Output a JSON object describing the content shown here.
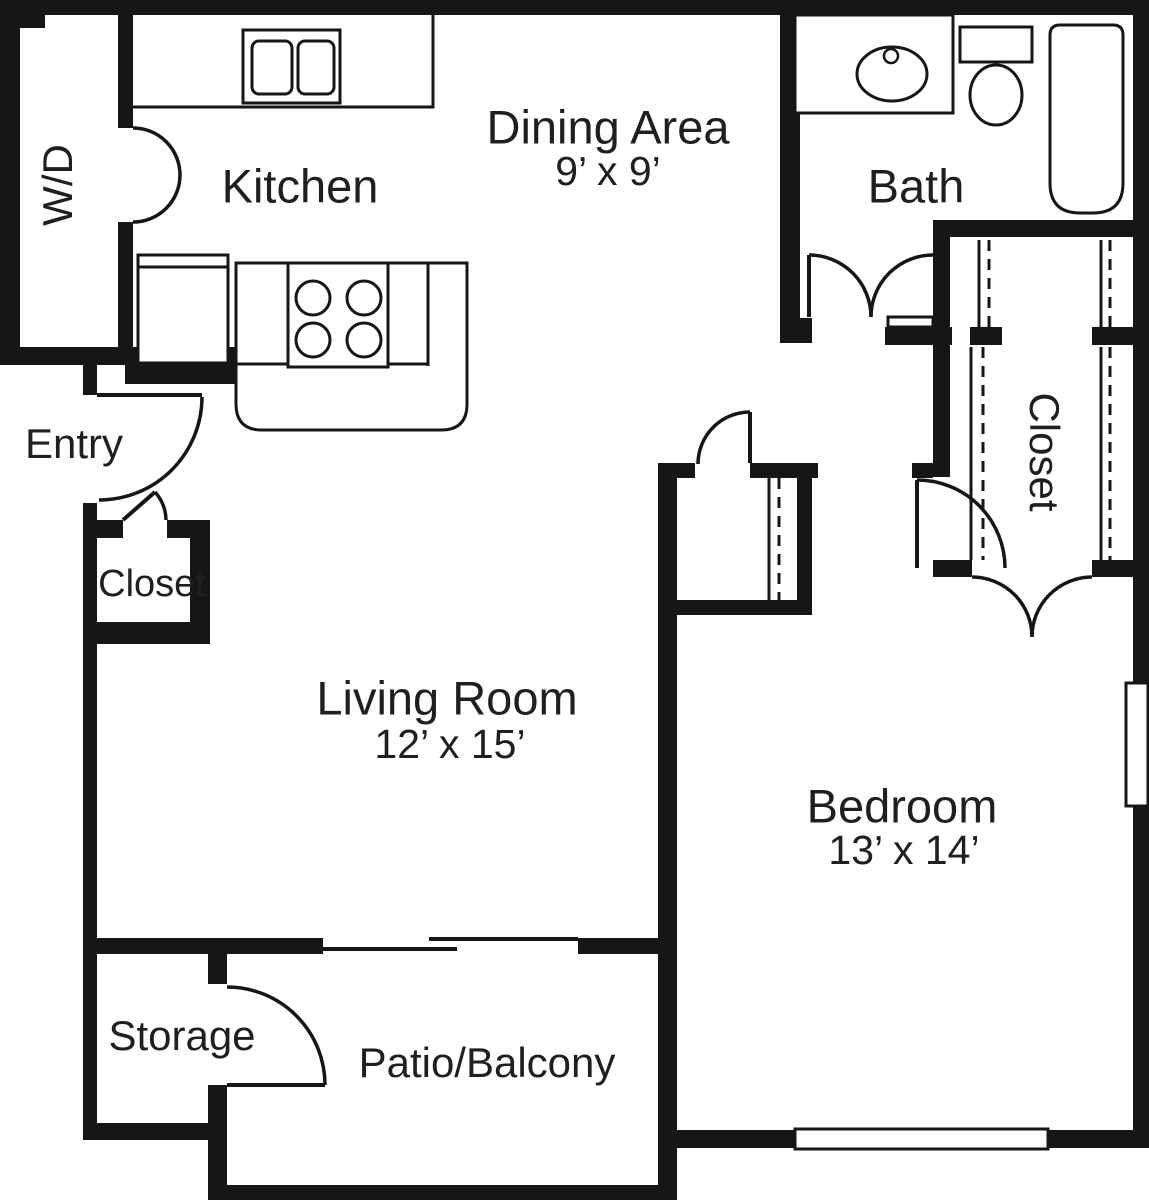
{
  "title": "One-bedroom apartment floor plan",
  "colors": {
    "wall": "#161616",
    "background": "#ffffff",
    "text": "#1f1f1f"
  },
  "rooms": {
    "wd": {
      "label": "W/D"
    },
    "kitchen": {
      "label": "Kitchen"
    },
    "dining": {
      "label": "Dining Area",
      "dims": "9’ x 9’"
    },
    "bath": {
      "label": "Bath"
    },
    "entry": {
      "label": "Entry"
    },
    "entry_closet": {
      "label": "Closet"
    },
    "living": {
      "label": "Living Room",
      "dims": "12’ x 15’"
    },
    "bedroom": {
      "label": "Bedroom",
      "dims": "13’ x 14’"
    },
    "bedroom_closet": {
      "label": "Closet"
    },
    "storage": {
      "label": "Storage"
    },
    "patio": {
      "label": "Patio/Balcony"
    }
  },
  "fixtures": [
    "washer-dryer-closet",
    "kitchen-double-sink",
    "refrigerator",
    "stove-4-burner",
    "counter-peninsula",
    "bathroom-sink",
    "toilet",
    "bathtub",
    "wire-shelving",
    "sliding-glass-door",
    "window"
  ]
}
